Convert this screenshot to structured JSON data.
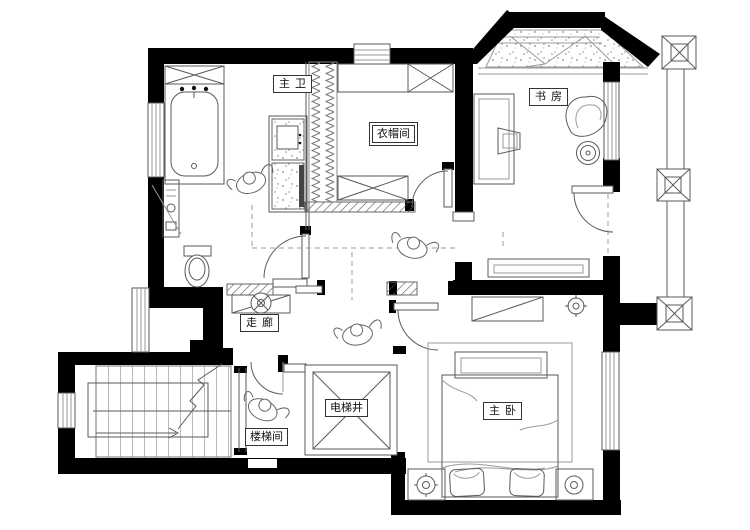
{
  "plan": {
    "type": "residential-floor-plan",
    "rooms": [
      {
        "id": "master-bathroom",
        "label": "主卫"
      },
      {
        "id": "cloakroom",
        "label": "衣帽间"
      },
      {
        "id": "study",
        "label": "书房"
      },
      {
        "id": "corridor",
        "label": "走廊"
      },
      {
        "id": "stairwell",
        "label": "楼梯间"
      },
      {
        "id": "elevator-shaft",
        "label": "电梯井"
      },
      {
        "id": "master-bedroom",
        "label": "主卧"
      }
    ],
    "colors": {
      "wall": "#000000",
      "line": "#5a5a5a",
      "light": "#9a9a9a",
      "background": "#ffffff"
    }
  }
}
